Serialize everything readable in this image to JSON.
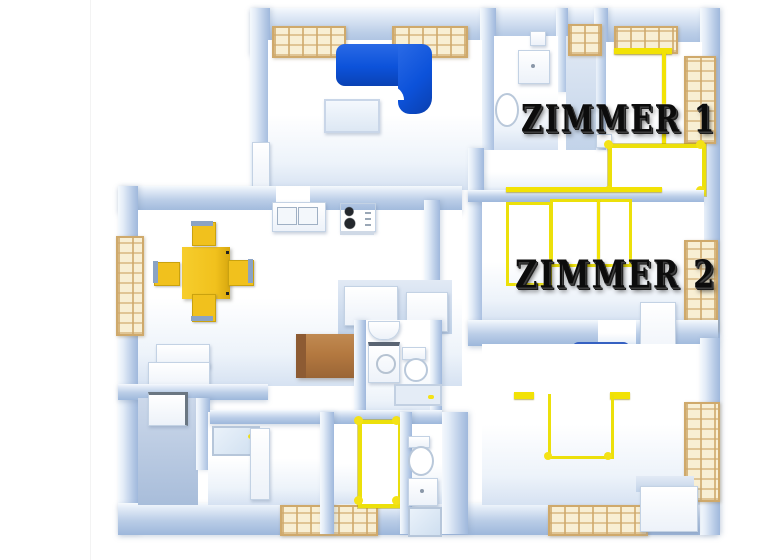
{
  "scene": {
    "type": "3d-floorplan-render",
    "labels": {
      "zimmer1": "ZIMMER 1",
      "zimmer2": "ZIMMER 2"
    }
  },
  "palette": {
    "wall_blue": "#9fb8dc",
    "wall_face_light": "#e4edf8",
    "floor_white": "#ffffff",
    "floor_shade": "#c2d3e9",
    "floor_dark": "#a8bdda",
    "sofa_blue": "#0c52da",
    "bed_blue": "#1256e0",
    "furniture_yellow": "#f1c11d",
    "frame_yellow": "#ece00a",
    "wood_window": "#f8efd4",
    "wood_window_frame": "#cfa96b",
    "couch_brown": "#b47940",
    "couch_brown_side": "#8d5b33",
    "label_black": "#0c0c0c"
  },
  "objects": [
    "corner-sofa-blue",
    "coffee-table",
    "dining-table",
    "dining-chair",
    "kitchen-sink",
    "stove",
    "fridge-cabinet",
    "brown-couch",
    "bathroom-sink",
    "toilet",
    "washing-machine",
    "shower-tray",
    "yellow-bed-frame",
    "blue-bed",
    "yellow-wardrobe-frame",
    "wood-window",
    "white-cabinet",
    "door"
  ]
}
